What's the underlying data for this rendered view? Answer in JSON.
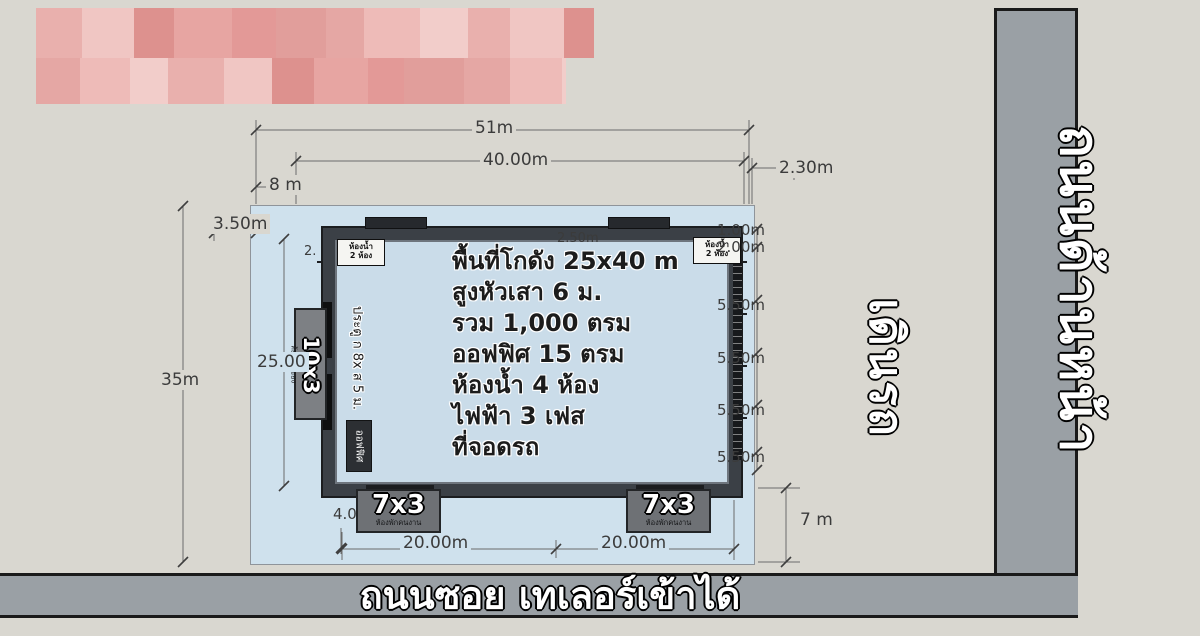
{
  "dims": {
    "top_total": "51m",
    "top_main": "40.00m",
    "top_left": "8 m",
    "top_right": "2.30m",
    "left_offset": "3.50m",
    "left_total": "35m",
    "left_main": "25.00",
    "inner_top_center": "2.50m",
    "inner_top_left": "2.",
    "right_stack": [
      "1.00m",
      "2.00m",
      "5.50m",
      "5.50m",
      "5.50m",
      "5.50m"
    ],
    "bottom_offset": "4.0",
    "bottom_left_span": "20.00m",
    "bottom_right_span": "20.00m",
    "bottom_gap": "7 m"
  },
  "building": {
    "info_lines": [
      "พื้นที่โกดัง 25x40 m",
      "สูงหัวเสา 6 ม.",
      "รวม 1,000 ตรม",
      "ออฟฟิศ 15 ตรม",
      "ห้องน้ำ 4 ห้อง",
      "ไฟฟ้า 3 เฟส",
      "ที่จอดรถ"
    ],
    "corner_label": [
      "ห้องน้ำ",
      "2 ห้อง"
    ],
    "door_spec": "ประตู ก 8x ส 5 ม.",
    "office": "ออฟฟิศ",
    "annex_left": {
      "size": "10x3",
      "caption": "ห้องเก็บของ"
    },
    "annex_bottom_left": {
      "size": "7x3",
      "caption": "ห้องพักคนงาน"
    },
    "annex_bottom_right": {
      "size": "7x3",
      "caption": "ห้องพักคนงาน"
    }
  },
  "roads": {
    "bottom": "ถนนซอย เทเลอร์เข้าได้",
    "right": "ถนนด้านหน้า",
    "flow": "เดินรถ"
  },
  "colors": {
    "plot": "#cfe1ed",
    "road": "#9aa0a5",
    "censor_palette": [
      "#e9b0ad",
      "#e19e9b",
      "#f0c6c3",
      "#e5a7a4",
      "#dd918e",
      "#eebbb8",
      "#e7a5a2",
      "#f2cdca",
      "#e39997"
    ]
  }
}
